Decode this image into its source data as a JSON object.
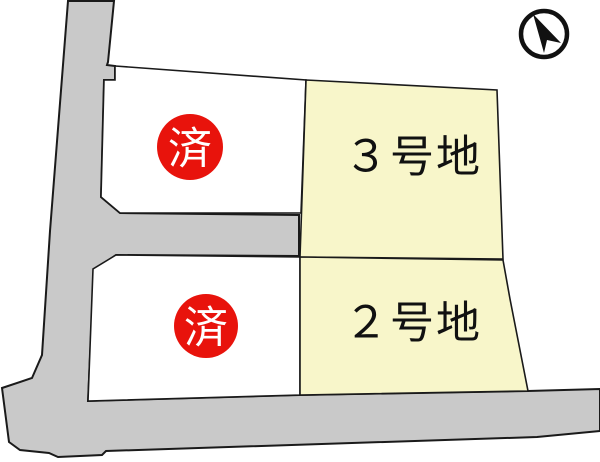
{
  "title": "site-plan",
  "colors": {
    "background": "#ffffff",
    "road": "#c9c9c9",
    "lot_available": "#f8f6ca",
    "lot_sold": "#ffffff",
    "outline": "#1a1a1a",
    "badge_red": "#e8130c",
    "badge_text": "#ffffff",
    "label_text": "#111111"
  },
  "lots": [
    {
      "id": "lot-upper-left",
      "status": "sold",
      "badge": "済"
    },
    {
      "id": "lot-3",
      "label": "３号地",
      "status": "available"
    },
    {
      "id": "lot-lower-left",
      "status": "sold",
      "badge": "済"
    },
    {
      "id": "lot-2",
      "label": "２号地",
      "status": "available"
    }
  ],
  "compass": {
    "icon": "north-arrow"
  }
}
